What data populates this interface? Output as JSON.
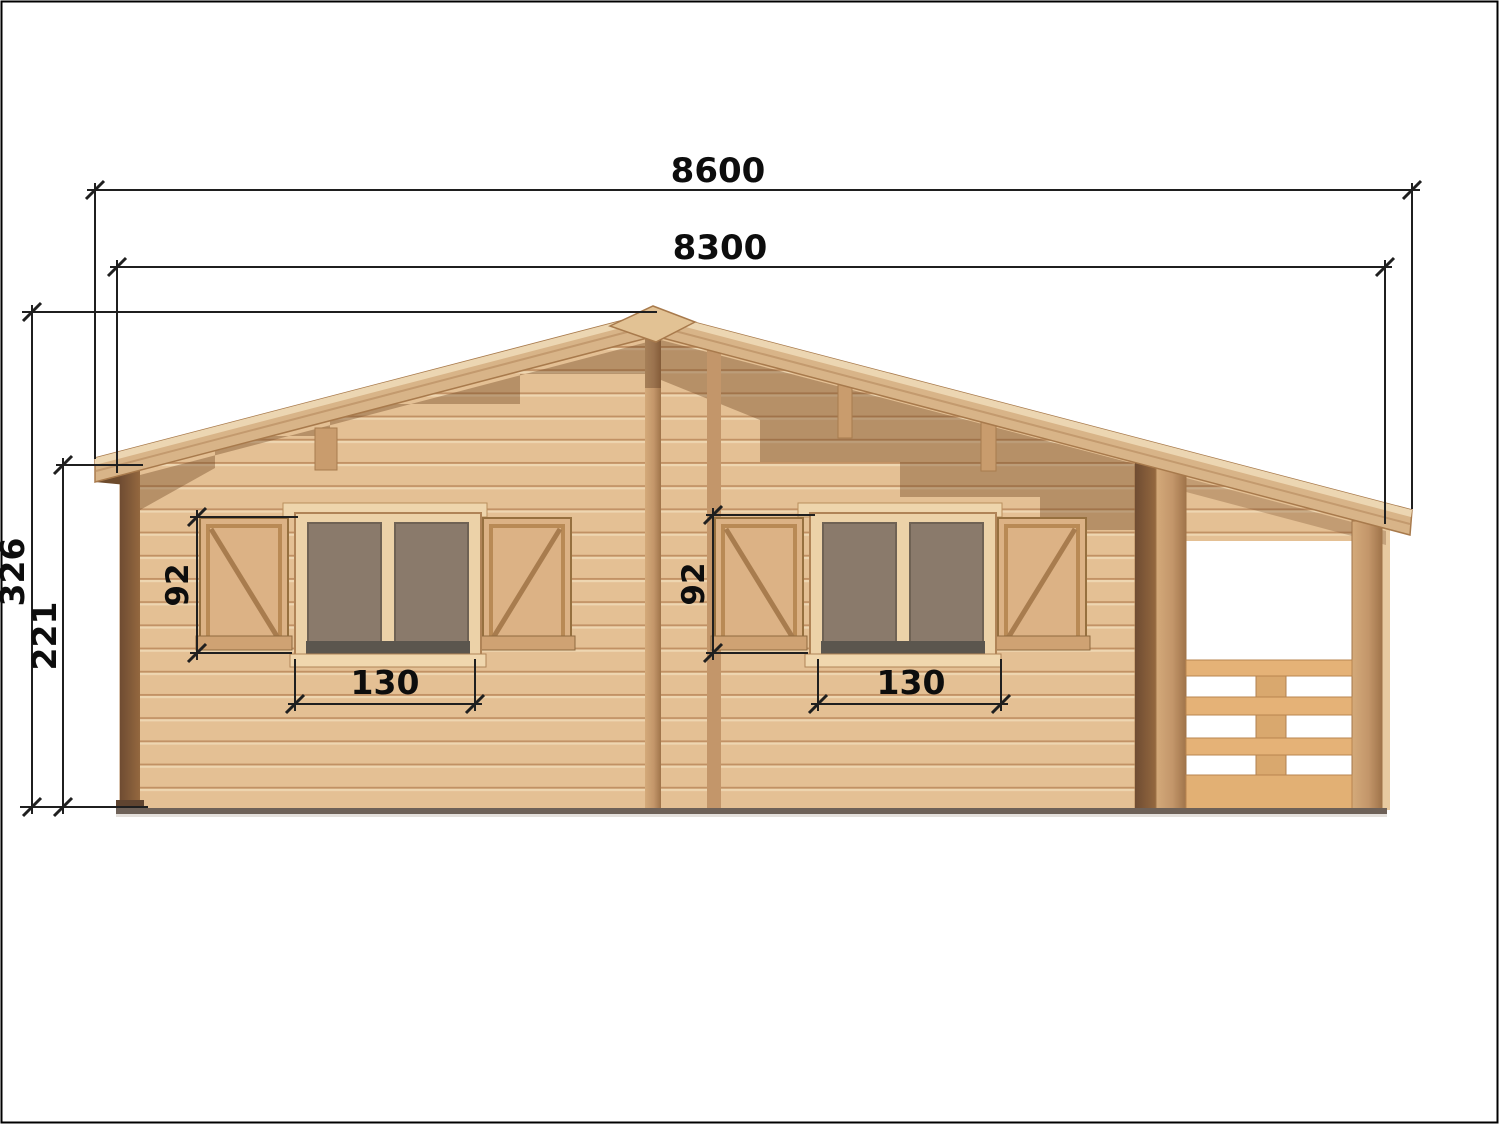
{
  "drawing": {
    "title": "wooden-cabin-front-elevation",
    "dimensions": {
      "overall_width": "8600",
      "wall_width": "8300",
      "ridge_height": "326",
      "eave_height": "221",
      "window_left": {
        "height": "92",
        "width": "130"
      },
      "window_right": {
        "height": "92",
        "width": "130"
      }
    },
    "colors": {
      "dimension_line": "#1f1f1f",
      "label_text": "#0d0d0d",
      "wood_base": "#e4c094",
      "wood_plank_line": "#c19164",
      "wood_dark_post": "#7d573b",
      "roof_fascia": "#d8b488",
      "roof_highlight": "#ecd6b2",
      "glass": "#8a7a6b",
      "sill_shadow": "#5b564e",
      "under_roof_shadow": "rgba(107,66,31,0.38)"
    }
  }
}
